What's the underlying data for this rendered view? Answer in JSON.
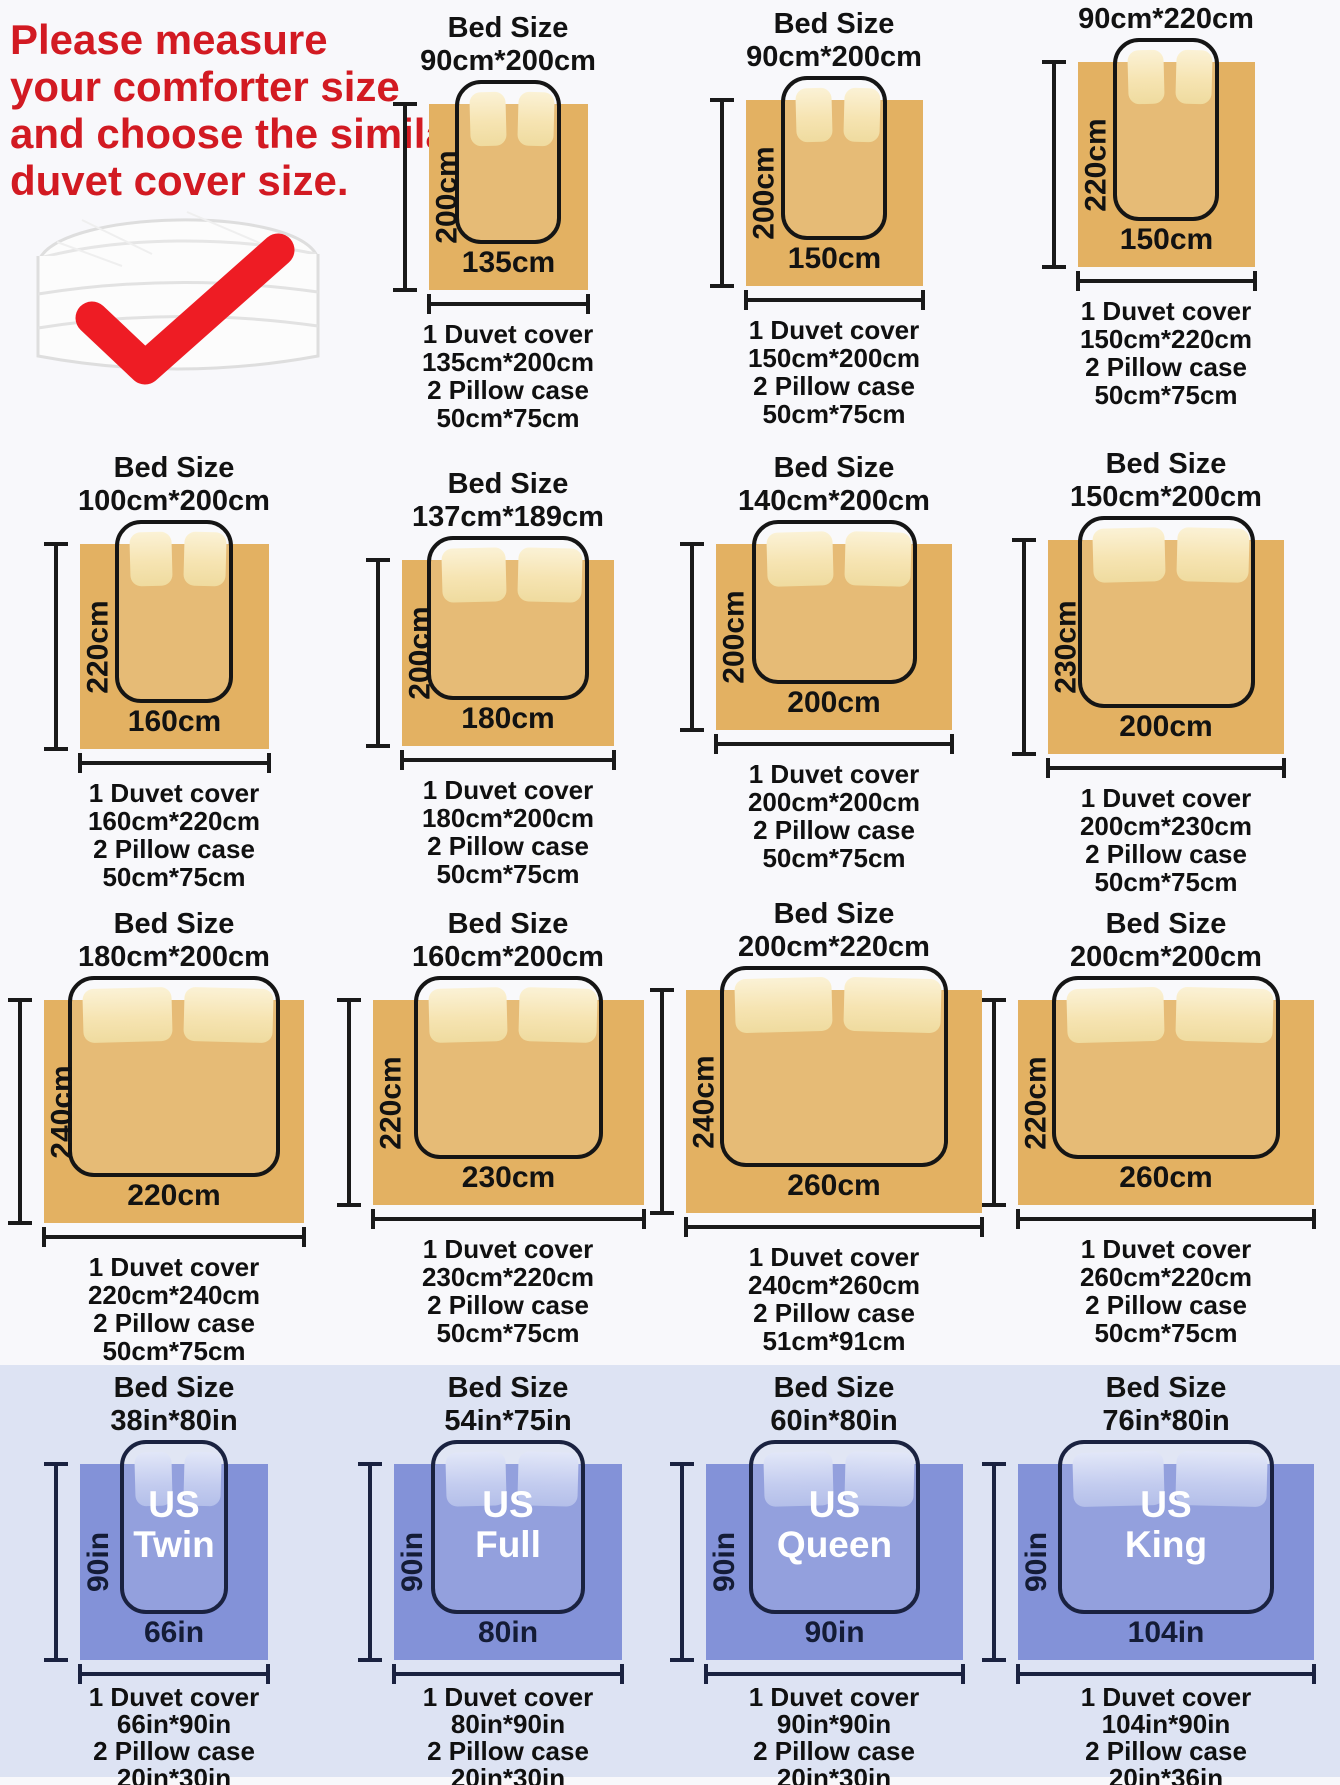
{
  "page": {
    "background": "#f8f8fb",
    "band_color": "#dde3f3",
    "accent_red": "#d21a22",
    "check_red": "#ee1c24",
    "tan_duvet": "#e3b162",
    "blue_duvet": "#8392d8",
    "outline_color": "#151515",
    "navy_text": "#141c36"
  },
  "intro": {
    "lines": [
      "Please measure",
      "your comforter size",
      "and choose the similar",
      "duvet cover size."
    ],
    "image": "folded-comforter",
    "icon": "red-checkmark"
  },
  "cards": [
    {
      "id": "duvet-135x200",
      "row": 1,
      "col": 2,
      "theme": "tan",
      "unit": "cm",
      "bed_size_title": "Bed Size",
      "bed_size": "90cm*200cm",
      "bed_w": 90,
      "bed_l": 200,
      "duvet_w": 135,
      "duvet_l": 200,
      "height_label": "200cm",
      "width_label": "135cm",
      "desc": [
        "1 Duvet cover",
        "135cm*200cm",
        "2 Pillow case",
        "50cm*75cm"
      ]
    },
    {
      "id": "duvet-150x200",
      "row": 1,
      "col": 3,
      "theme": "tan",
      "unit": "cm",
      "bed_size_title": "Bed Size",
      "bed_size": "90cm*200cm",
      "bed_w": 90,
      "bed_l": 200,
      "duvet_w": 150,
      "duvet_l": 200,
      "height_label": "200cm",
      "width_label": "150cm",
      "desc": [
        "1 Duvet cover",
        "150cm*200cm",
        "2 Pillow case",
        "50cm*75cm"
      ]
    },
    {
      "id": "duvet-150x220",
      "row": 1,
      "col": 4,
      "theme": "tan",
      "unit": "cm",
      "bed_size_title": "Bed Size",
      "bed_size": "90cm*220cm",
      "bed_w": 90,
      "bed_l": 220,
      "duvet_w": 150,
      "duvet_l": 220,
      "height_label": "220cm",
      "width_label": "150cm",
      "desc": [
        "1 Duvet cover",
        "150cm*220cm",
        "2 Pillow case",
        "50cm*75cm"
      ]
    },
    {
      "id": "duvet-160x220",
      "row": 2,
      "col": 1,
      "theme": "tan",
      "unit": "cm",
      "bed_size_title": "Bed Size",
      "bed_size": "100cm*200cm",
      "bed_w": 100,
      "bed_l": 200,
      "duvet_w": 160,
      "duvet_l": 220,
      "height_label": "220cm",
      "width_label": "160cm",
      "desc": [
        "1 Duvet cover",
        "160cm*220cm",
        "2 Pillow case",
        "50cm*75cm"
      ]
    },
    {
      "id": "duvet-180x200",
      "row": 2,
      "col": 2,
      "theme": "tan",
      "unit": "cm",
      "bed_size_title": "Bed Size",
      "bed_size": "137cm*189cm",
      "bed_w": 137,
      "bed_l": 189,
      "duvet_w": 180,
      "duvet_l": 200,
      "height_label": "200cm",
      "width_label": "180cm",
      "desc": [
        "1 Duvet cover",
        "180cm*200cm",
        "2 Pillow case",
        "50cm*75cm"
      ]
    },
    {
      "id": "duvet-200x200",
      "row": 2,
      "col": 3,
      "theme": "tan",
      "unit": "cm",
      "bed_size_title": "Bed Size",
      "bed_size": "140cm*200cm",
      "bed_w": 140,
      "bed_l": 200,
      "duvet_w": 200,
      "duvet_l": 200,
      "height_label": "200cm",
      "width_label": "200cm",
      "desc": [
        "1 Duvet cover",
        "200cm*200cm",
        "2 Pillow case",
        "50cm*75cm"
      ]
    },
    {
      "id": "duvet-200x230",
      "row": 2,
      "col": 4,
      "theme": "tan",
      "unit": "cm",
      "bed_size_title": "Bed Size",
      "bed_size": "150cm*200cm",
      "bed_w": 150,
      "bed_l": 200,
      "duvet_w": 200,
      "duvet_l": 230,
      "height_label": "230cm",
      "width_label": "200cm",
      "desc": [
        "1 Duvet cover",
        "200cm*230cm",
        "2 Pillow case",
        "50cm*75cm"
      ]
    },
    {
      "id": "duvet-220x240",
      "row": 3,
      "col": 1,
      "theme": "tan",
      "unit": "cm",
      "bed_size_title": "Bed Size",
      "bed_size": "180cm*200cm",
      "bed_w": 180,
      "bed_l": 200,
      "duvet_w": 220,
      "duvet_l": 240,
      "height_label": "240cm",
      "width_label": "220cm",
      "desc": [
        "1 Duvet cover",
        "220cm*240cm",
        "2 Pillow case",
        "50cm*75cm"
      ]
    },
    {
      "id": "duvet-230x220",
      "row": 3,
      "col": 2,
      "theme": "tan",
      "unit": "cm",
      "bed_size_title": "Bed Size",
      "bed_size": "160cm*200cm",
      "bed_w": 160,
      "bed_l": 200,
      "duvet_w": 230,
      "duvet_l": 220,
      "height_label": "220cm",
      "width_label": "230cm",
      "desc": [
        "1 Duvet cover",
        "230cm*220cm",
        "2 Pillow case",
        "50cm*75cm"
      ]
    },
    {
      "id": "duvet-240x260",
      "row": 3,
      "col": 3,
      "theme": "tan",
      "unit": "cm",
      "bed_size_title": "Bed Size",
      "bed_size": "200cm*220cm",
      "bed_w": 200,
      "bed_l": 220,
      "duvet_w": 260,
      "duvet_l": 240,
      "height_label": "240cm",
      "width_label": "260cm",
      "desc": [
        "1 Duvet cover",
        "240cm*260cm",
        "2 Pillow case",
        "51cm*91cm"
      ]
    },
    {
      "id": "duvet-260x220",
      "row": 3,
      "col": 4,
      "theme": "tan",
      "unit": "cm",
      "bed_size_title": "Bed Size",
      "bed_size": "200cm*200cm",
      "bed_w": 200,
      "bed_l": 200,
      "duvet_w": 260,
      "duvet_l": 220,
      "height_label": "220cm",
      "width_label": "260cm",
      "desc": [
        "1 Duvet cover",
        "260cm*220cm",
        "2 Pillow case",
        "50cm*75cm"
      ]
    },
    {
      "id": "us-twin",
      "row": 4,
      "col": 1,
      "theme": "blue",
      "unit": "in",
      "bed_size_title": "Bed Size",
      "bed_size": "38in*80in",
      "bed_w": 38,
      "bed_l": 80,
      "duvet_w": 66,
      "duvet_l": 90,
      "height_label": "90in",
      "width_label": "66in",
      "us_name": [
        "US",
        "Twin"
      ],
      "desc": [
        "1 Duvet cover",
        "66in*90in",
        "2 Pillow case",
        "20in*30in"
      ]
    },
    {
      "id": "us-full",
      "row": 4,
      "col": 2,
      "theme": "blue",
      "unit": "in",
      "bed_size_title": "Bed Size",
      "bed_size": "54in*75in",
      "bed_w": 54,
      "bed_l": 75,
      "duvet_w": 80,
      "duvet_l": 90,
      "height_label": "90in",
      "width_label": "80in",
      "us_name": [
        "US",
        "Full"
      ],
      "desc": [
        "1 Duvet cover",
        "80in*90in",
        "2 Pillow case",
        "20in*30in"
      ]
    },
    {
      "id": "us-queen",
      "row": 4,
      "col": 3,
      "theme": "blue",
      "unit": "in",
      "bed_size_title": "Bed Size",
      "bed_size": "60in*80in",
      "bed_w": 60,
      "bed_l": 80,
      "duvet_w": 90,
      "duvet_l": 90,
      "height_label": "90in",
      "width_label": "90in",
      "us_name": [
        "US",
        "Queen"
      ],
      "desc": [
        "1 Duvet cover",
        "90in*90in",
        "2 Pillow case",
        "20in*30in"
      ]
    },
    {
      "id": "us-king",
      "row": 4,
      "col": 4,
      "theme": "blue",
      "unit": "in",
      "bed_size_title": "Bed Size",
      "bed_size": "76in*80in",
      "bed_w": 76,
      "bed_l": 80,
      "duvet_w": 104,
      "duvet_l": 90,
      "height_label": "90in",
      "width_label": "104in",
      "us_name": [
        "US",
        "King"
      ],
      "desc": [
        "1 Duvet cover",
        "104in*90in",
        "2 Pillow case",
        "20in*36in"
      ]
    }
  ]
}
